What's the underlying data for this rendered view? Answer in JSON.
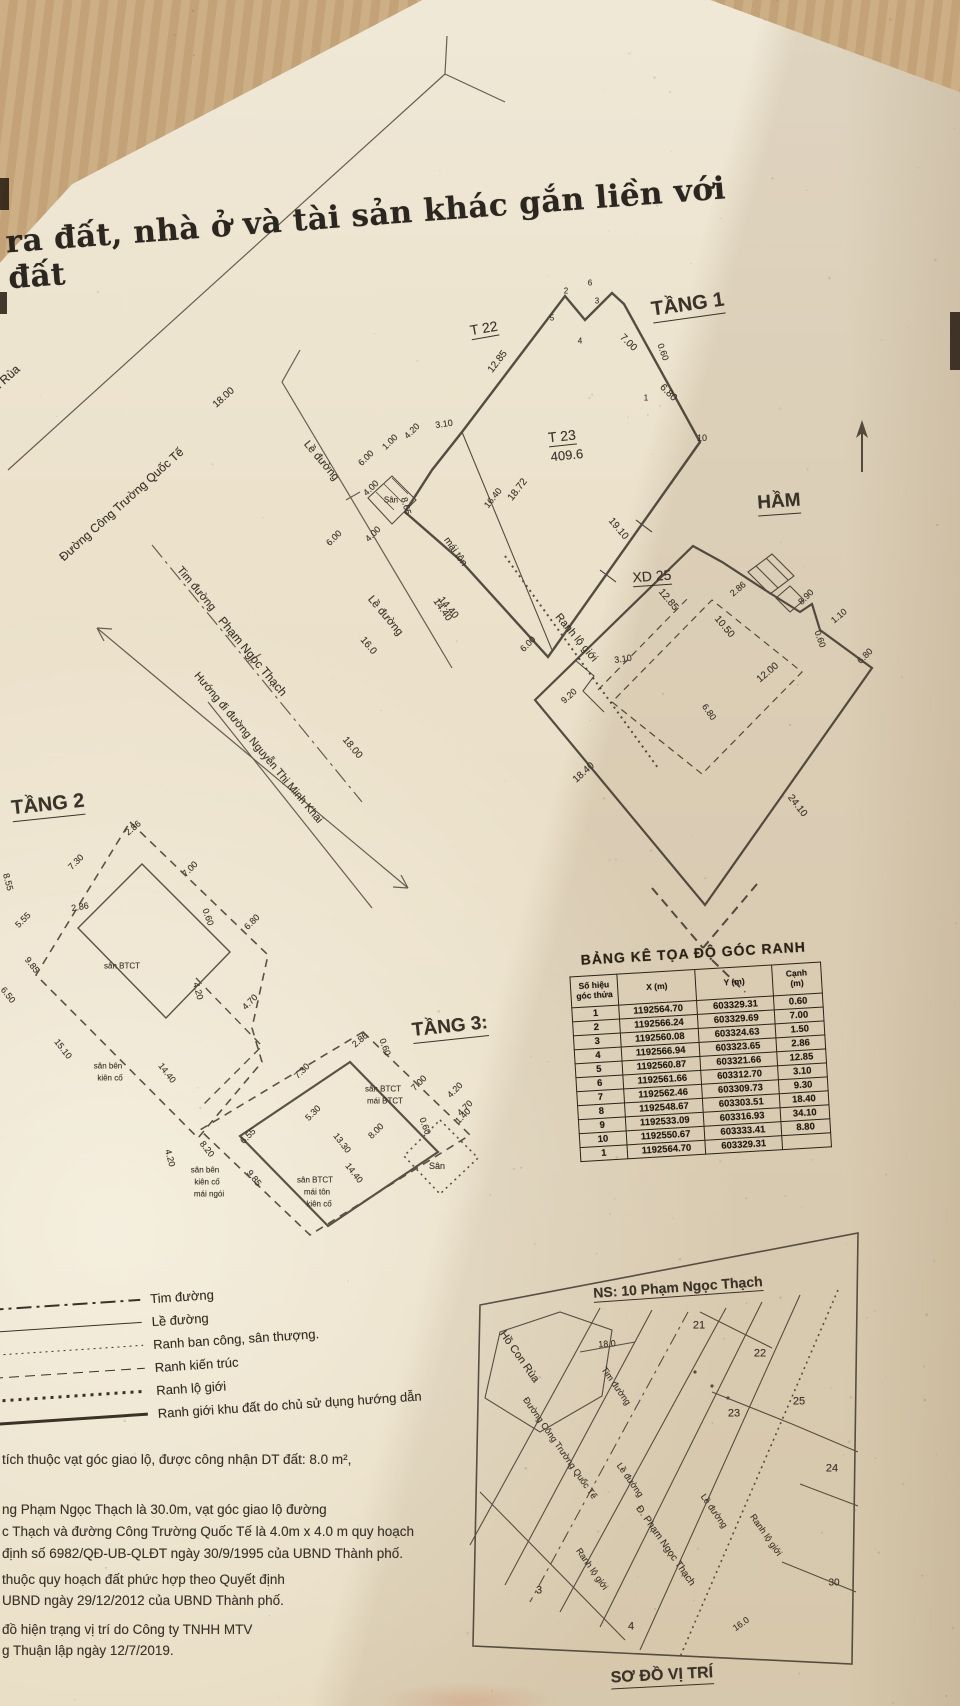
{
  "document": {
    "title_fragment": "ra đất, nhà ở và tài sản khác gắn liền với đất"
  },
  "plans": {
    "streets": {
      "labels": [
        {
          "t": "Hồ Con Rùa",
          "x": -6,
          "y": 390,
          "r": -42,
          "fs": 12
        },
        {
          "t": "Đường Công Trường Quốc Tế",
          "x": 122,
          "y": 505,
          "r": -42,
          "fs": 12
        },
        {
          "t": "18.00",
          "x": 224,
          "y": 398,
          "r": -42,
          "fs": 10
        },
        {
          "t": "Lề đường",
          "x": 321,
          "y": 461,
          "r": 50,
          "fs": 11
        },
        {
          "t": "Tim đường",
          "x": 196,
          "y": 589,
          "r": 50,
          "fs": 11
        },
        {
          "t": "Phạm Ngọc Thạch",
          "x": 252,
          "y": 657,
          "r": 50,
          "fs": 12
        },
        {
          "t": "Hướng đi đường Nguyễn Thị Minh Khai",
          "x": 258,
          "y": 748,
          "r": 50,
          "fs": 11
        },
        {
          "t": "Lề đường",
          "x": 385,
          "y": 616,
          "r": 50,
          "fs": 11
        },
        {
          "t": "16.0",
          "x": 368,
          "y": 646,
          "r": 50,
          "fs": 10
        },
        {
          "t": "18.00",
          "x": 352,
          "y": 748,
          "r": 50,
          "fs": 10
        },
        {
          "t": "14.40",
          "x": 448,
          "y": 608,
          "r": 50,
          "fs": 10
        }
      ]
    },
    "tang1": {
      "labels": [
        {
          "t": "TẦNG 1",
          "x": 688,
          "y": 306,
          "r": -8,
          "fs": 20,
          "b": 1,
          "u": 1
        },
        {
          "t": "T 22",
          "x": 484,
          "y": 329,
          "r": -10,
          "fs": 14,
          "u": 1
        },
        {
          "t": "T 23",
          "x": 562,
          "y": 437,
          "r": -6,
          "fs": 14,
          "u": 1
        },
        {
          "t": "409.6",
          "x": 567,
          "y": 456,
          "r": -6,
          "fs": 13
        },
        {
          "t": "12.85",
          "x": 498,
          "y": 362,
          "r": -52,
          "fs": 10
        },
        {
          "t": "5",
          "x": 552,
          "y": 318,
          "fs": 8
        },
        {
          "t": "2",
          "x": 566,
          "y": 291,
          "fs": 8
        },
        {
          "t": "4",
          "x": 580,
          "y": 341,
          "fs": 8
        },
        {
          "t": "3",
          "x": 597,
          "y": 301,
          "fs": 8
        },
        {
          "t": "6",
          "x": 590,
          "y": 283,
          "fs": 8
        },
        {
          "t": "7.00",
          "x": 628,
          "y": 343,
          "r": 45,
          "fs": 10
        },
        {
          "t": "0.60",
          "x": 663,
          "y": 352,
          "r": 70,
          "fs": 9
        },
        {
          "t": "6.80",
          "x": 668,
          "y": 393,
          "r": 45,
          "fs": 10
        },
        {
          "t": "1",
          "x": 646,
          "y": 398,
          "fs": 8
        },
        {
          "t": "10",
          "x": 702,
          "y": 438,
          "fs": 9
        },
        {
          "t": "19.10",
          "x": 618,
          "y": 529,
          "r": 50,
          "fs": 10
        },
        {
          "t": "3.10",
          "x": 444,
          "y": 424,
          "r": -8,
          "fs": 9
        },
        {
          "t": "1.00",
          "x": 390,
          "y": 442,
          "r": -45,
          "fs": 9
        },
        {
          "t": "4.20",
          "x": 412,
          "y": 431,
          "r": -45,
          "fs": 9
        },
        {
          "t": "6.00",
          "x": 366,
          "y": 458,
          "r": -45,
          "fs": 9
        },
        {
          "t": "4.00",
          "x": 371,
          "y": 488,
          "r": -45,
          "fs": 9
        },
        {
          "t": "8.65",
          "x": 406,
          "y": 506,
          "r": 75,
          "fs": 9
        },
        {
          "t": "Sân",
          "x": 391,
          "y": 500,
          "fs": 8
        },
        {
          "t": "4.00",
          "x": 373,
          "y": 534,
          "r": -45,
          "fs": 9
        },
        {
          "t": "6.00",
          "x": 334,
          "y": 538,
          "r": -45,
          "fs": 9
        },
        {
          "t": "16.40",
          "x": 493,
          "y": 498,
          "r": -52,
          "fs": 9
        },
        {
          "t": "18.72",
          "x": 518,
          "y": 490,
          "r": -52,
          "fs": 10
        },
        {
          "t": "mái tôn",
          "x": 455,
          "y": 552,
          "r": 55,
          "fs": 10
        },
        {
          "t": "14.40",
          "x": 442,
          "y": 610,
          "r": 55,
          "fs": 10
        },
        {
          "t": "6.00",
          "x": 528,
          "y": 644,
          "r": -45,
          "fs": 9
        },
        {
          "t": "Ranh lộ giới",
          "x": 576,
          "y": 638,
          "r": 50,
          "fs": 11
        },
        {
          "t": "9.20",
          "x": 569,
          "y": 696,
          "r": -42,
          "fs": 9
        },
        {
          "t": "3.10",
          "x": 623,
          "y": 659,
          "r": -8,
          "fs": 9
        }
      ]
    },
    "ham": {
      "labels": [
        {
          "t": "HẦM",
          "x": 779,
          "y": 503,
          "r": -4,
          "fs": 19,
          "b": 1,
          "u": 1
        },
        {
          "t": "XD 25",
          "x": 652,
          "y": 577,
          "r": -4,
          "fs": 14,
          "u": 1
        },
        {
          "t": "12.85",
          "x": 668,
          "y": 600,
          "r": 50,
          "fs": 10
        },
        {
          "t": "10.50",
          "x": 724,
          "y": 627,
          "r": 50,
          "fs": 10
        },
        {
          "t": "2.86",
          "x": 738,
          "y": 589,
          "r": -40,
          "fs": 9
        },
        {
          "t": "8.90",
          "x": 806,
          "y": 597,
          "r": -45,
          "fs": 9
        },
        {
          "t": "1.10",
          "x": 839,
          "y": 616,
          "r": -40,
          "fs": 9
        },
        {
          "t": "0.60",
          "x": 820,
          "y": 639,
          "r": 70,
          "fs": 9
        },
        {
          "t": "6.80",
          "x": 865,
          "y": 656,
          "r": -45,
          "fs": 9
        },
        {
          "t": "12.00",
          "x": 768,
          "y": 673,
          "r": -40,
          "fs": 10
        },
        {
          "t": "6.80",
          "x": 709,
          "y": 712,
          "r": 55,
          "fs": 9
        },
        {
          "t": "24.10",
          "x": 797,
          "y": 806,
          "r": 52,
          "fs": 10
        },
        {
          "t": "18.40",
          "x": 584,
          "y": 773,
          "r": -42,
          "fs": 10
        }
      ]
    },
    "tang2": {
      "labels": [
        {
          "t": "TẦNG 2",
          "x": 48,
          "y": 806,
          "r": -6,
          "fs": 20,
          "b": 1,
          "u": 1
        },
        {
          "t": "2.86",
          "x": 133,
          "y": 828,
          "r": -40,
          "fs": 9
        },
        {
          "t": "7.00",
          "x": 190,
          "y": 869,
          "r": -45,
          "fs": 9
        },
        {
          "t": "7.30",
          "x": 76,
          "y": 862,
          "r": -45,
          "fs": 9
        },
        {
          "t": "2.86",
          "x": 80,
          "y": 907,
          "r": -10,
          "fs": 9
        },
        {
          "t": "5.55",
          "x": 23,
          "y": 920,
          "r": -45,
          "fs": 9
        },
        {
          "t": "9.85",
          "x": 32,
          "y": 965,
          "r": 52,
          "fs": 9
        },
        {
          "t": "8.55",
          "x": 8,
          "y": 882,
          "r": 75,
          "fs": 9
        },
        {
          "t": "0.60",
          "x": 208,
          "y": 917,
          "r": 70,
          "fs": 9
        },
        {
          "t": "6.80",
          "x": 252,
          "y": 922,
          "r": -45,
          "fs": 9
        },
        {
          "t": "sân BTCT",
          "x": 122,
          "y": 966,
          "fs": 8
        },
        {
          "t": "4.20",
          "x": 198,
          "y": 991,
          "r": 75,
          "fs": 9
        },
        {
          "t": "4.70",
          "x": 250,
          "y": 1002,
          "r": -45,
          "fs": 9
        },
        {
          "t": "14.40",
          "x": 167,
          "y": 1073,
          "r": 52,
          "fs": 9
        },
        {
          "t": "15.10",
          "x": 63,
          "y": 1049,
          "r": 52,
          "fs": 9
        },
        {
          "t": "6.50",
          "x": 8,
          "y": 995,
          "r": 52,
          "fs": 9
        },
        {
          "t": "sân bên",
          "x": 108,
          "y": 1066,
          "fs": 8
        },
        {
          "t": "kiên cố",
          "x": 110,
          "y": 1078,
          "fs": 8
        }
      ]
    },
    "tang3": {
      "labels": [
        {
          "t": "TẦNG 3:",
          "x": 450,
          "y": 1028,
          "r": -6,
          "fs": 19,
          "b": 1,
          "u": 1
        },
        {
          "t": "2.86",
          "x": 360,
          "y": 1040,
          "r": -40,
          "fs": 9
        },
        {
          "t": "0.60",
          "x": 385,
          "y": 1047,
          "r": 70,
          "fs": 9
        },
        {
          "t": "7.00",
          "x": 419,
          "y": 1083,
          "r": -45,
          "fs": 9
        },
        {
          "t": "7.30",
          "x": 302,
          "y": 1071,
          "r": -45,
          "fs": 9
        },
        {
          "t": "sân BTCT",
          "x": 383,
          "y": 1089,
          "fs": 8
        },
        {
          "t": "mái BTCT",
          "x": 385,
          "y": 1101,
          "fs": 8
        },
        {
          "t": "5.30",
          "x": 313,
          "y": 1113,
          "r": -45,
          "fs": 9
        },
        {
          "t": "6.55",
          "x": 248,
          "y": 1136,
          "r": -45,
          "fs": 9
        },
        {
          "t": "8.00",
          "x": 376,
          "y": 1131,
          "r": -45,
          "fs": 9
        },
        {
          "t": "0.60",
          "x": 425,
          "y": 1126,
          "r": 70,
          "fs": 9
        },
        {
          "t": "1.40",
          "x": 463,
          "y": 1116,
          "r": -45,
          "fs": 9
        },
        {
          "t": "4.20",
          "x": 455,
          "y": 1090,
          "r": -45,
          "fs": 9
        },
        {
          "t": "4.70",
          "x": 465,
          "y": 1108,
          "r": -45,
          "fs": 9
        },
        {
          "t": "Sân",
          "x": 437,
          "y": 1166,
          "fs": 9
        },
        {
          "t": "9.85",
          "x": 254,
          "y": 1178,
          "r": 52,
          "fs": 9
        },
        {
          "t": "8.20",
          "x": 207,
          "y": 1149,
          "r": 52,
          "fs": 9
        },
        {
          "t": "4.20",
          "x": 170,
          "y": 1158,
          "r": 75,
          "fs": 9
        },
        {
          "t": "13.30",
          "x": 342,
          "y": 1143,
          "r": 52,
          "fs": 9
        },
        {
          "t": "14.40",
          "x": 354,
          "y": 1173,
          "r": 52,
          "fs": 9
        },
        {
          "t": "sân bên",
          "x": 205,
          "y": 1170,
          "fs": 8
        },
        {
          "t": "kiên cố",
          "x": 207,
          "y": 1182,
          "fs": 8
        },
        {
          "t": "mái ngói",
          "x": 209,
          "y": 1194,
          "fs": 8
        },
        {
          "t": "sân BTCT",
          "x": 315,
          "y": 1180,
          "fs": 8
        },
        {
          "t": "mái tôn",
          "x": 317,
          "y": 1192,
          "fs": 8
        },
        {
          "t": "kiên cố",
          "x": 319,
          "y": 1204,
          "fs": 8
        }
      ]
    }
  },
  "coordinate_table": {
    "title": "BẢNG KÊ TỌA ĐỘ GÓC RANH",
    "headers": [
      "Số hiệu\ngóc thửa",
      "X (m)",
      "Y (m)",
      "Cạnh\n(m)"
    ],
    "rows": [
      [
        "1",
        "1192564.70",
        "603329.31",
        "0.60"
      ],
      [
        "2",
        "1192566.24",
        "603329.69",
        "7.00"
      ],
      [
        "3",
        "1192560.08",
        "603324.63",
        "1.50"
      ],
      [
        "4",
        "1192566.94",
        "603323.65",
        "2.86"
      ],
      [
        "5",
        "1192560.87",
        "603321.66",
        "12.85"
      ],
      [
        "6",
        "1192561.66",
        "603312.70",
        "3.10"
      ],
      [
        "7",
        "1192562.46",
        "603309.73",
        "9.30"
      ],
      [
        "8",
        "1192548.67",
        "603303.51",
        "18.40"
      ],
      [
        "9",
        "1192533.09",
        "603316.93",
        "34.10"
      ],
      [
        "10",
        "1192550.67",
        "603333.41",
        "8.80"
      ],
      [
        "1",
        "1192564.70",
        "603329.31",
        ""
      ]
    ]
  },
  "legend": {
    "items": [
      {
        "label": "Tim đường"
      },
      {
        "label": "Lề đường"
      },
      {
        "label": "Ranh ban công, sân thượng."
      },
      {
        "label": "Ranh kiến trúc"
      },
      {
        "label": "Ranh lộ giới"
      },
      {
        "label": "Ranh giới khu đất do chủ sử dụng hướng dẫn"
      }
    ]
  },
  "notes": {
    "lines": [
      {
        "t": "tích thuộc vạt góc giao lộ, được công nhận DT đất: 8.0 m²,",
        "x": 2,
        "y": 1452,
        "fs": 13.5,
        "a": "l"
      },
      {
        "t": "ng Phạm Ngọc Thạch là 30.0m, vạt góc giao lộ đường",
        "x": 2,
        "y": 1502,
        "fs": 13.5,
        "a": "l"
      },
      {
        "t": "c Thạch và đường Công Trường Quốc Tế là 4.0m x 4.0 m quy hoạch",
        "x": 2,
        "y": 1524,
        "fs": 13.5,
        "a": "l"
      },
      {
        "t": "định số 6982/QĐ-UB-QLĐT ngày 30/9/1995 của UBND Thành phố.",
        "x": 2,
        "y": 1546,
        "fs": 13.5,
        "a": "l"
      },
      {
        "t": "thuộc quy hoạch đất phức hợp theo Quyết định",
        "x": 2,
        "y": 1572,
        "fs": 13.5,
        "a": "l"
      },
      {
        "t": "UBND ngày 29/12/2012 của UBND Thành phố.",
        "x": 2,
        "y": 1593,
        "fs": 13.5,
        "a": "l"
      },
      {
        "t": "đồ hiện trạng vị trí do Công ty TNHH MTV",
        "x": 2,
        "y": 1622,
        "fs": 13.5,
        "a": "l"
      },
      {
        "t": "g Thuận lập ngày 12/7/2019.",
        "x": 2,
        "y": 1643,
        "fs": 13.5,
        "a": "l"
      }
    ]
  },
  "map": {
    "labels": [
      {
        "t": "NS: 10 Phạm Ngọc Thạch",
        "x": 678,
        "y": 1288,
        "r": -4,
        "fs": 14,
        "b": 1,
        "u": 1
      },
      {
        "t": "Hồ Con Rùa",
        "x": 519,
        "y": 1357,
        "r": 55,
        "fs": 11
      },
      {
        "t": "18.0",
        "x": 607,
        "y": 1344,
        "r": -4,
        "fs": 9
      },
      {
        "t": "21",
        "x": 699,
        "y": 1326,
        "fs": 11
      },
      {
        "t": "22",
        "x": 760,
        "y": 1354,
        "fs": 11
      },
      {
        "t": "23",
        "x": 734,
        "y": 1414,
        "fs": 11
      },
      {
        "t": "25",
        "x": 799,
        "y": 1402,
        "fs": 11
      },
      {
        "t": "24",
        "x": 832,
        "y": 1469,
        "fs": 11
      },
      {
        "t": "3",
        "x": 539,
        "y": 1591,
        "fs": 11
      },
      {
        "t": "4",
        "x": 631,
        "y": 1627,
        "fs": 11
      },
      {
        "t": "30",
        "x": 834,
        "y": 1583,
        "fs": 10
      },
      {
        "t": "Đường Công Trường Quốc Tế",
        "x": 560,
        "y": 1448,
        "r": 55,
        "fs": 9
      },
      {
        "t": "Tim đường",
        "x": 616,
        "y": 1386,
        "r": 55,
        "fs": 9
      },
      {
        "t": "Lề đường",
        "x": 630,
        "y": 1480,
        "r": 55,
        "fs": 9
      },
      {
        "t": "Lề đường",
        "x": 714,
        "y": 1511,
        "r": 55,
        "fs": 9
      },
      {
        "t": "Đ. Phạm Ngọc Thạch",
        "x": 665,
        "y": 1546,
        "r": 55,
        "fs": 10
      },
      {
        "t": "Ranh lộ giới",
        "x": 592,
        "y": 1569,
        "r": 55,
        "fs": 9
      },
      {
        "t": "Ranh lộ giới",
        "x": 766,
        "y": 1535,
        "r": 55,
        "fs": 9
      },
      {
        "t": "16.0",
        "x": 741,
        "y": 1624,
        "r": -35,
        "fs": 9
      },
      {
        "t": "SƠ ĐỒ VỊ TRÍ",
        "x": 662,
        "y": 1677,
        "r": -3,
        "fs": 16,
        "b": 1,
        "u": 1
      }
    ]
  }
}
